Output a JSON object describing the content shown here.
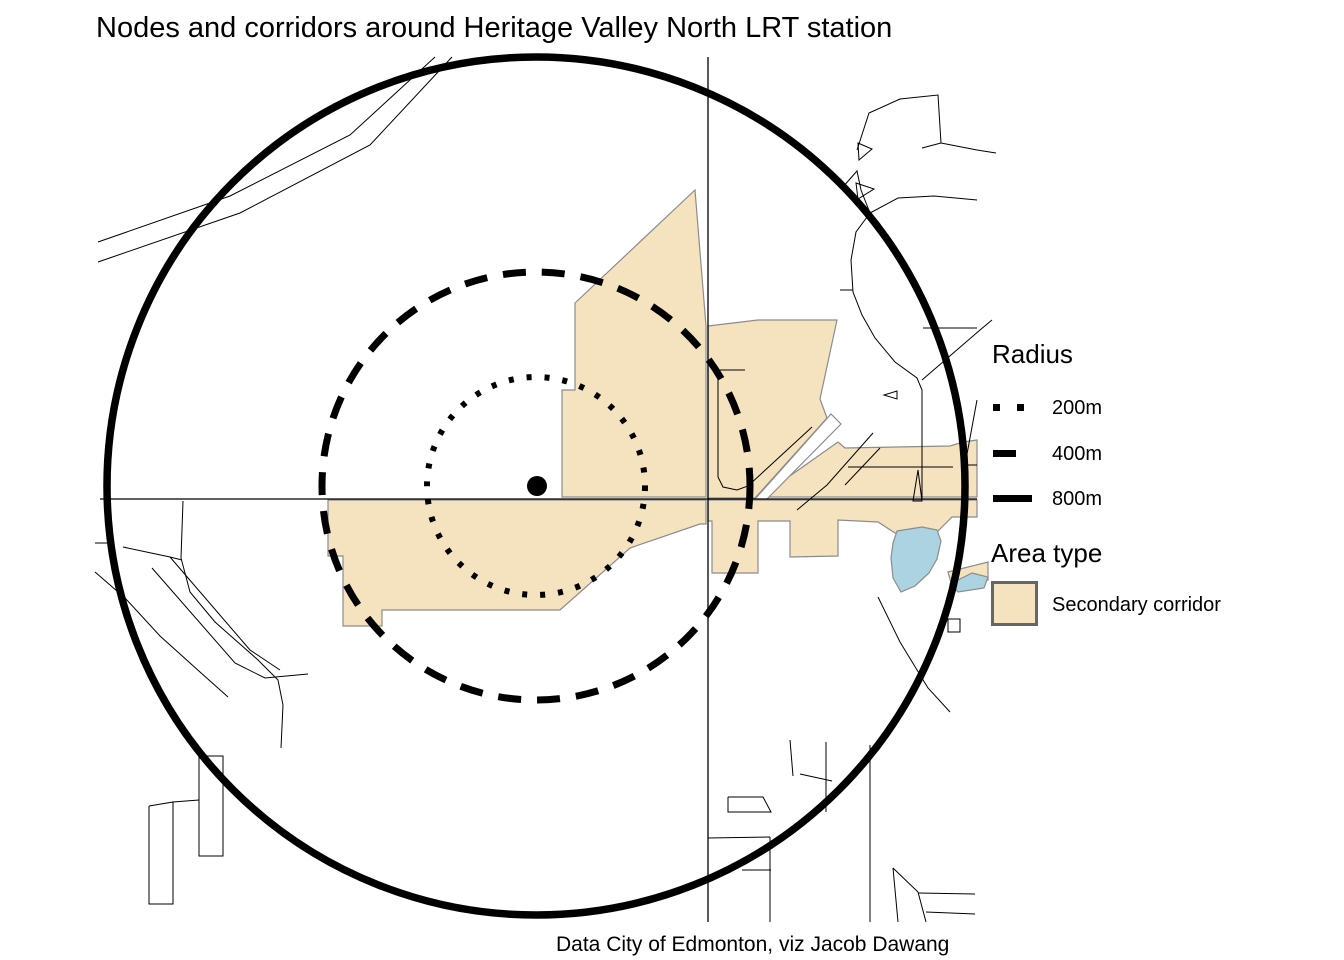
{
  "title": "Nodes and corridors around Heritage Valley North LRT station",
  "caption": "Data City of Edmonton, viz Jacob Dawang",
  "legend": {
    "radius": {
      "title": "Radius",
      "items": [
        {
          "label": "200m",
          "style": "dotted"
        },
        {
          "label": "400m",
          "style": "dashed"
        },
        {
          "label": "800m",
          "style": "solid"
        }
      ]
    },
    "area_type": {
      "title": "Area type",
      "items": [
        {
          "label": "Secondary corridor"
        }
      ]
    }
  },
  "colors": {
    "corridor": "#F5E2BF",
    "water": "#ABD3E2",
    "polygon_border": "#8c8c8c",
    "road": "#000000",
    "circle": "#000000",
    "background": "#ffffff"
  },
  "map": {
    "station": {
      "name": "Heritage Valley North LRT station",
      "cx": 537,
      "cy": 486,
      "r": 10
    },
    "center_px": [
      536,
      486
    ],
    "radius_circles": [
      {
        "radius_m": 200,
        "r_px": 109,
        "stroke_width": 6,
        "dash": "5 13"
      },
      {
        "radius_m": 400,
        "r_px": 214,
        "stroke_width": 7,
        "dash": "23 16"
      },
      {
        "radius_m": 800,
        "r_px": 429,
        "stroke_width": 7.5,
        "dash": ""
      }
    ],
    "axis_lines": {
      "horizontal": {
        "y": 499,
        "x1": 100,
        "x2": 977
      },
      "vertical": {
        "x": 708,
        "y1": 57,
        "y2": 922
      }
    },
    "corridor_polygons": [
      {
        "name": "corridor-west-upper",
        "pts": [
          [
            575,
            303
          ],
          [
            695,
            190
          ],
          [
            706,
            326
          ],
          [
            706,
            497
          ],
          [
            562,
            497
          ],
          [
            562,
            390
          ],
          [
            575,
            390
          ]
        ]
      },
      {
        "name": "corridor-west-strip",
        "pts": [
          [
            328,
            500
          ],
          [
            706,
            500
          ],
          [
            706,
            524
          ],
          [
            700,
            524
          ],
          [
            630,
            548
          ],
          [
            560,
            610
          ],
          [
            382,
            610
          ],
          [
            382,
            626
          ],
          [
            343,
            626
          ],
          [
            343,
            556
          ],
          [
            328,
            556
          ]
        ]
      },
      {
        "name": "corridor-east-mid",
        "pts": [
          [
            708,
            326
          ],
          [
            758,
            320
          ],
          [
            837,
            320
          ],
          [
            820,
            399
          ],
          [
            827,
            418
          ],
          [
            755,
            498
          ],
          [
            708,
            498
          ]
        ]
      },
      {
        "name": "corridor-northeast-band",
        "pts": [
          [
            760,
            497
          ],
          [
            838,
            442
          ],
          [
            845,
            448
          ],
          [
            950,
            446
          ],
          [
            963,
            442
          ],
          [
            977,
            440
          ],
          [
            977,
            497
          ]
        ]
      },
      {
        "name": "corridor-east-strip",
        "pts": [
          [
            708,
            500
          ],
          [
            977,
            500
          ],
          [
            977,
            517
          ],
          [
            952,
            517
          ],
          [
            937,
            532
          ],
          [
            895,
            533
          ],
          [
            878,
            522
          ],
          [
            838,
            520
          ],
          [
            838,
            556
          ],
          [
            790,
            557
          ],
          [
            790,
            521
          ],
          [
            758,
            521
          ],
          [
            758,
            573
          ],
          [
            712,
            573
          ],
          [
            712,
            521
          ],
          [
            708,
            521
          ]
        ]
      },
      {
        "name": "corridor-east-tail",
        "pts": [
          [
            948,
            572
          ],
          [
            988,
            562
          ],
          [
            988,
            580
          ],
          [
            952,
            586
          ]
        ]
      }
    ],
    "white_overlays": [
      {
        "name": "road-wedge-gap",
        "pts": [
          [
            755,
            499
          ],
          [
            831,
            414
          ],
          [
            841,
            424
          ],
          [
            766,
            500
          ]
        ]
      }
    ],
    "water_polygons": [
      {
        "name": "pond",
        "pts": [
          [
            897,
            531
          ],
          [
            922,
            527
          ],
          [
            937,
            530
          ],
          [
            941,
            541
          ],
          [
            937,
            559
          ],
          [
            929,
            573
          ],
          [
            915,
            586
          ],
          [
            901,
            592
          ],
          [
            893,
            578
          ],
          [
            891,
            558
          ],
          [
            893,
            543
          ]
        ]
      },
      {
        "name": "pond-sliver",
        "pts": [
          [
            950,
            584
          ],
          [
            972,
            573
          ],
          [
            988,
            577
          ],
          [
            984,
            588
          ],
          [
            958,
            592
          ]
        ]
      }
    ],
    "roads": [
      [
        [
          98,
          242
        ],
        [
          230,
          196
        ],
        [
          350,
          135
        ],
        [
          435,
          57
        ]
      ],
      [
        [
          98,
          262
        ],
        [
          240,
          213
        ],
        [
          370,
          145
        ],
        [
          452,
          57
        ]
      ],
      [
        [
          857,
          150
        ],
        [
          869,
          113
        ],
        [
          900,
          99
        ],
        [
          938,
          95
        ],
        [
          941,
          143
        ],
        [
          922,
          148
        ]
      ],
      [
        [
          941,
          143
        ],
        [
          977,
          150
        ],
        [
          996,
          153
        ]
      ],
      [
        [
          842,
          188
        ],
        [
          857,
          171
        ],
        [
          861,
          190
        ],
        [
          870,
          213
        ]
      ],
      [
        [
          870,
          213
        ],
        [
          856,
          232
        ],
        [
          851,
          260
        ],
        [
          853,
          292
        ],
        [
          862,
          315
        ],
        [
          875,
          338
        ],
        [
          895,
          362
        ],
        [
          917,
          378
        ],
        [
          922,
          390
        ],
        [
          922,
          500
        ]
      ],
      [
        [
          840,
          290
        ],
        [
          853,
          290
        ]
      ],
      [
        [
          870,
          213
        ],
        [
          898,
          198
        ],
        [
          934,
          196
        ],
        [
          977,
          200
        ]
      ],
      [
        [
          922,
          380
        ],
        [
          980,
          330
        ],
        [
          992,
          320
        ]
      ],
      [
        [
          923,
          328
        ],
        [
          977,
          328
        ]
      ],
      [
        [
          873,
          433
        ],
        [
          827,
          485
        ],
        [
          797,
          510
        ]
      ],
      [
        [
          845,
          485
        ],
        [
          880,
          448
        ]
      ],
      [
        [
          712,
          370
        ],
        [
          745,
          370
        ]
      ],
      [
        [
          718,
          372
        ],
        [
          718,
          477
        ],
        [
          723,
          487
        ],
        [
          737,
          490
        ],
        [
          748,
          486
        ],
        [
          812,
          427
        ]
      ],
      [
        [
          848,
          467
        ],
        [
          953,
          467
        ]
      ],
      [
        [
          963,
          465
        ],
        [
          977,
          465
        ]
      ],
      [
        [
          977,
          400
        ],
        [
          965,
          465
        ]
      ],
      [
        [
          878,
          597
        ],
        [
          900,
          642
        ],
        [
          928,
          688
        ],
        [
          950,
          712
        ]
      ],
      [
        [
          95,
          543
        ],
        [
          113,
          543
        ]
      ],
      [
        [
          95,
          572
        ],
        [
          125,
          598
        ],
        [
          160,
          636
        ],
        [
          200,
          672
        ],
        [
          228,
          697
        ]
      ],
      [
        [
          183,
          501
        ],
        [
          181,
          558
        ],
        [
          190,
          592
        ],
        [
          215,
          622
        ],
        [
          258,
          660
        ],
        [
          278,
          680
        ],
        [
          283,
          705
        ],
        [
          281,
          748
        ]
      ],
      [
        [
          123,
          547
        ],
        [
          170,
          557
        ],
        [
          182,
          560
        ]
      ],
      [
        [
          152,
          568
        ],
        [
          235,
          663
        ],
        [
          265,
          678
        ],
        [
          308,
          674
        ]
      ],
      [
        [
          170,
          557
        ],
        [
          250,
          650
        ],
        [
          280,
          670
        ]
      ],
      [
        [
          199,
          756
        ],
        [
          223,
          756
        ],
        [
          223,
          856
        ],
        [
          199,
          856
        ],
        [
          199,
          756
        ]
      ],
      [
        [
          149,
          806
        ],
        [
          173,
          802
        ],
        [
          173,
          904
        ],
        [
          149,
          904
        ],
        [
          149,
          806
        ]
      ],
      [
        [
          173,
          802
        ],
        [
          199,
          800
        ]
      ],
      [
        [
          790,
          740
        ],
        [
          793,
          776
        ]
      ],
      [
        [
          728,
          797
        ],
        [
          763,
          797
        ],
        [
          771,
          812
        ],
        [
          728,
          812
        ],
        [
          728,
          797
        ]
      ],
      [
        [
          708,
          838
        ],
        [
          770,
          837
        ]
      ],
      [
        [
          742,
          870
        ],
        [
          771,
          870
        ]
      ],
      [
        [
          770,
          837
        ],
        [
          770,
          922
        ]
      ],
      [
        [
          870,
          745
        ],
        [
          870,
          922
        ]
      ],
      [
        [
          800,
          774
        ],
        [
          832,
          781
        ]
      ],
      [
        [
          893,
          868
        ],
        [
          898,
          922
        ]
      ],
      [
        [
          893,
          868
        ],
        [
          918,
          892
        ],
        [
          926,
          922
        ]
      ],
      [
        [
          918,
          893
        ],
        [
          975,
          894
        ]
      ],
      [
        [
          926,
          912
        ],
        [
          975,
          914
        ]
      ],
      [
        [
          826,
          742
        ],
        [
          826,
          812
        ]
      ],
      [
        [
          948,
          619
        ],
        [
          960,
          619
        ],
        [
          960,
          632
        ],
        [
          948,
          632
        ],
        [
          948,
          619
        ]
      ]
    ],
    "road_triangles": [
      {
        "name": "road-loop-triangle-1",
        "pts": [
          [
            858,
            143
          ],
          [
            872,
            149
          ],
          [
            859,
            160
          ]
        ]
      },
      {
        "name": "road-loop-triangle-2",
        "pts": [
          [
            856,
            183
          ],
          [
            874,
            189
          ],
          [
            858,
            199
          ]
        ]
      },
      {
        "name": "road-loop-triangle-3",
        "pts": [
          [
            897,
            391
          ],
          [
            884,
            395
          ],
          [
            897,
            399
          ]
        ]
      },
      {
        "name": "road-spike",
        "pts": [
          [
            913,
            501
          ],
          [
            918,
            470
          ],
          [
            922,
            501
          ]
        ]
      }
    ]
  }
}
